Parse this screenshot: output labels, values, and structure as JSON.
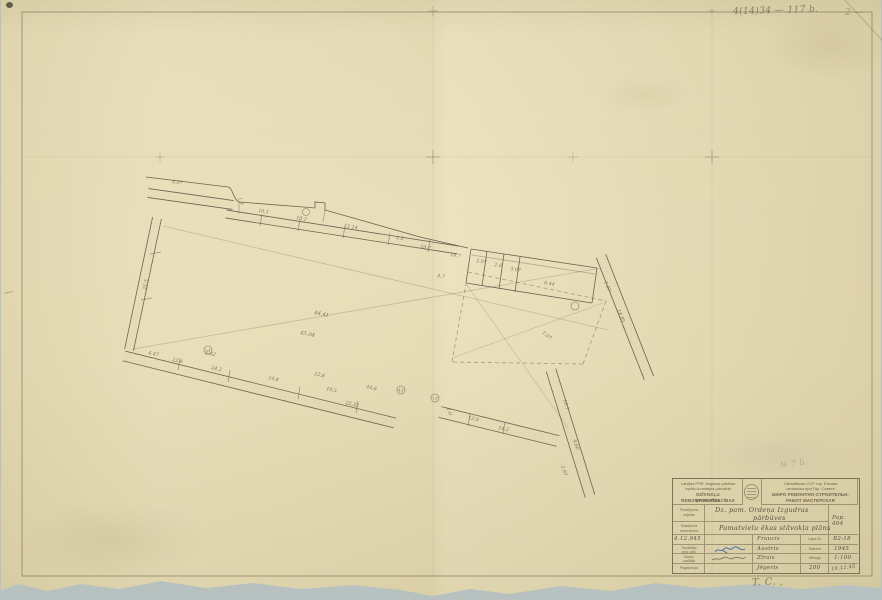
{
  "colors": {
    "paper": "#e9deb4",
    "backdrop": "#b7c2c0",
    "ink": "#6e6452",
    "pencil": "#8c8164",
    "blue_ink": "#3c57a6"
  },
  "annotations": {
    "top_right_note": "4(14)34 — 117 b.",
    "top_right_note2": "2 —",
    "above_titleblock_note": "№ 7 b.",
    "bottom_note": "T. C.  ,"
  },
  "title_block": {
    "org_left": [
      "Latvijas PSR Jelgavas pilsētas",
      "izpildu komitejas pārvalde",
      "DZĪVOKĻU REMONTCELTNIECĪBAS",
      "DARBNĪCA"
    ],
    "org_right": [
      "Латвийская ССР гор. Елгава",
      "исполком при Гор. Совете",
      "БЮРО РЕМОНТНО-СТРОИТЕЛЬН.",
      "РАБОТ МАСТЕРСКАЯ"
    ],
    "row_object": {
      "label_l1": "Pasūtījuma",
      "label_l2": "objekts",
      "value_l1": "Dz. pam. Ordeņa Izgudras",
      "value_l2": "pārbūves",
      "right_value": "Pap. 404"
    },
    "row_drawing": {
      "label_l1": "Rasējuma",
      "label_l2": "nosaukums",
      "value": "Pamatvielu ēkas stāvokļa plāns"
    },
    "sign_rows": [
      {
        "c1": "4.12.945",
        "c3": "Fraucis",
        "c4": "Lapa Nr.",
        "c5": "B2-18"
      },
      {
        "c1_l1": "Sastādīja",
        "c1_l2": "proj. vad.",
        "c3": "Austris",
        "c4": "Datums",
        "c5": "1945"
      },
      {
        "c1_l1": "Darbu",
        "c1_l2": "vadītājs",
        "c3": "Zīrais",
        "c4": "Mērogs",
        "c5": "1:100"
      },
      {
        "c1": "Pagatavoja",
        "c3": "Jēgeris",
        "c4": "200",
        "c5": "19.12.45"
      }
    ]
  },
  "drawing": {
    "bands": [
      {
        "x1": 148,
        "y1": 193,
        "x2": 233,
        "y2": 205,
        "w": 9
      },
      {
        "x1": 226,
        "y1": 214,
        "x2": 458,
        "y2": 250,
        "w": 8
      },
      {
        "x1": 157,
        "y1": 218,
        "x2": 129,
        "y2": 350,
        "w": 9
      },
      {
        "x1": 124,
        "y1": 356,
        "x2": 395,
        "y2": 423,
        "w": 10
      },
      {
        "x1": 440,
        "y1": 412,
        "x2": 558,
        "y2": 441,
        "w": 11
      },
      {
        "x1": 601,
        "y1": 256,
        "x2": 649,
        "y2": 378,
        "w": 10
      },
      {
        "x1": 551,
        "y1": 370,
        "x2": 590,
        "y2": 496,
        "w": 10
      }
    ],
    "paths": [
      {
        "d": "M146,177 L228,187 C233,188 233,199 239,202 L303,207 L315,208 L315,202 L325,203 L325,210 L420,237 L468,248"
      }
    ],
    "lines": [
      {
        "x1": 471,
        "y1": 249,
        "x2": 597,
        "y2": 268
      },
      {
        "x1": 597,
        "y1": 268,
        "x2": 592,
        "y2": 303
      },
      {
        "x1": 592,
        "y1": 303,
        "x2": 466,
        "y2": 283
      },
      {
        "x1": 466,
        "y1": 283,
        "x2": 471,
        "y2": 249
      },
      {
        "x1": 487,
        "y1": 251,
        "x2": 482,
        "y2": 286
      },
      {
        "x1": 504,
        "y1": 254,
        "x2": 499,
        "y2": 289
      },
      {
        "x1": 520,
        "y1": 257,
        "x2": 515,
        "y2": 292
      },
      {
        "x1": 472,
        "y1": 255,
        "x2": 595,
        "y2": 274,
        "o": 0.45
      },
      {
        "x1": 163,
        "y1": 226,
        "x2": 608,
        "y2": 330,
        "o": 0.3
      },
      {
        "x1": 133,
        "y1": 349,
        "x2": 601,
        "y2": 268,
        "o": 0.3
      },
      {
        "x1": 466,
        "y1": 284,
        "x2": 568,
        "y2": 428,
        "o": 0.25
      },
      {
        "x1": 452,
        "y1": 358,
        "x2": 603,
        "y2": 303,
        "o": 0.25
      },
      {
        "x1": 468,
        "y1": 272,
        "x2": 606,
        "y2": 301,
        "d": 1,
        "o": 0.55
      },
      {
        "x1": 606,
        "y1": 301,
        "x2": 583,
        "y2": 364,
        "d": 1,
        "o": 0.55
      },
      {
        "x1": 583,
        "y1": 364,
        "x2": 452,
        "y2": 362,
        "d": 1,
        "o": 0.55
      },
      {
        "x1": 452,
        "y1": 362,
        "x2": 466,
        "y2": 284,
        "d": 1,
        "o": 0.55
      },
      {
        "x1": 262,
        "y1": 214,
        "x2": 260,
        "y2": 226,
        "o": 0.6
      },
      {
        "x1": 300,
        "y1": 219,
        "x2": 298,
        "y2": 231,
        "o": 0.6
      },
      {
        "x1": 345,
        "y1": 226,
        "x2": 343,
        "y2": 238,
        "o": 0.6
      },
      {
        "x1": 390,
        "y1": 233,
        "x2": 388,
        "y2": 245,
        "o": 0.6
      },
      {
        "x1": 430,
        "y1": 240,
        "x2": 428,
        "y2": 252,
        "o": 0.6
      },
      {
        "x1": 180,
        "y1": 358,
        "x2": 178,
        "y2": 370,
        "o": 0.6
      },
      {
        "x1": 230,
        "y1": 370,
        "x2": 228,
        "y2": 382,
        "o": 0.6
      },
      {
        "x1": 300,
        "y1": 387,
        "x2": 298,
        "y2": 399,
        "o": 0.6
      },
      {
        "x1": 358,
        "y1": 401,
        "x2": 356,
        "y2": 413,
        "o": 0.6
      },
      {
        "x1": 150,
        "y1": 254,
        "x2": 161,
        "y2": 252,
        "o": 0.6
      },
      {
        "x1": 141,
        "y1": 300,
        "x2": 152,
        "y2": 298,
        "o": 0.6
      },
      {
        "x1": 470,
        "y1": 414,
        "x2": 468,
        "y2": 426,
        "o": 0.6
      },
      {
        "x1": 505,
        "y1": 422,
        "x2": 503,
        "y2": 434,
        "o": 0.6
      },
      {
        "x1": 239,
        "y1": 202,
        "x2": 239,
        "y2": 214,
        "o": 0.5
      },
      {
        "x1": 325,
        "y1": 210,
        "x2": 323,
        "y2": 222,
        "o": 0.5
      },
      {
        "x1": 433,
        "y1": 12,
        "x2": 433,
        "y2": 576,
        "o": 0.1,
        "c": "pencil"
      },
      {
        "x1": 712,
        "y1": 12,
        "x2": 712,
        "y2": 576,
        "o": 0.1,
        "c": "pencil"
      },
      {
        "x1": 22,
        "y1": 157,
        "x2": 872,
        "y2": 157,
        "o": 0.09,
        "c": "pencil"
      }
    ],
    "circles": [
      {
        "x": 208,
        "y": 350,
        "r": 4,
        "t": "2.4"
      },
      {
        "x": 401,
        "y": 390,
        "r": 4,
        "t": "4.4"
      },
      {
        "x": 435,
        "y": 398,
        "r": 4,
        "t": "1.8"
      },
      {
        "x": 575,
        "y": 306,
        "r": 4,
        "t": ""
      },
      {
        "x": 306,
        "y": 212,
        "r": 3.5,
        "t": ""
      }
    ],
    "labels": [
      {
        "x": 172,
        "y": 183,
        "r": 8,
        "t": "8.97"
      },
      {
        "x": 238,
        "y": 198,
        "r": 70,
        "t": "1.9"
      },
      {
        "x": 258,
        "y": 212,
        "r": 9,
        "t": "10.1"
      },
      {
        "x": 296,
        "y": 219,
        "r": 9,
        "t": "10.2"
      },
      {
        "x": 344,
        "y": 227,
        "r": 9,
        "t": "11.14"
      },
      {
        "x": 396,
        "y": 239,
        "r": 9,
        "t": "1.2"
      },
      {
        "x": 420,
        "y": 248,
        "r": 9,
        "t": "10.7"
      },
      {
        "x": 450,
        "y": 256,
        "r": 9,
        "t": "14.7"
      },
      {
        "x": 476,
        "y": 262,
        "r": 10,
        "t": "2.97"
      },
      {
        "x": 494,
        "y": 266,
        "r": 10,
        "t": "2.0"
      },
      {
        "x": 510,
        "y": 270,
        "r": 10,
        "t": "3.07"
      },
      {
        "x": 544,
        "y": 284,
        "r": 10,
        "t": "6.44"
      },
      {
        "x": 146,
        "y": 290,
        "r": -80,
        "t": "21.5"
      },
      {
        "x": 148,
        "y": 354,
        "r": 12,
        "t": "4.47"
      },
      {
        "x": 172,
        "y": 361,
        "r": 12,
        "t": "22.6"
      },
      {
        "x": 205,
        "y": 354,
        "r": 12,
        "t": "2.62"
      },
      {
        "x": 211,
        "y": 369,
        "r": 12,
        "t": "24.2"
      },
      {
        "x": 268,
        "y": 379,
        "r": 13,
        "t": "14.8"
      },
      {
        "x": 314,
        "y": 375,
        "r": 13,
        "t": "22.8"
      },
      {
        "x": 326,
        "y": 390,
        "r": 13,
        "t": "18.5"
      },
      {
        "x": 345,
        "y": 404,
        "r": 13,
        "t": "22.32"
      },
      {
        "x": 366,
        "y": 388,
        "r": 13,
        "t": "44.8"
      },
      {
        "x": 437,
        "y": 277,
        "r": 10,
        "t": "4.7"
      },
      {
        "x": 314,
        "y": 314,
        "r": 12,
        "t": "44.41",
        "s": 5.2
      },
      {
        "x": 300,
        "y": 334,
        "r": 12,
        "t": "45.04",
        "s": 5.2
      },
      {
        "x": 617,
        "y": 310,
        "r": 68,
        "t": "14.85"
      },
      {
        "x": 604,
        "y": 282,
        "r": 68,
        "t": "1.07"
      },
      {
        "x": 563,
        "y": 400,
        "r": 72,
        "t": "10.7"
      },
      {
        "x": 573,
        "y": 440,
        "r": 72,
        "t": "4.60"
      },
      {
        "x": 561,
        "y": 466,
        "r": 72,
        "t": "2.97"
      },
      {
        "x": 468,
        "y": 419,
        "r": 13,
        "t": "12.9"
      },
      {
        "x": 498,
        "y": 429,
        "r": 13,
        "t": "14.2"
      },
      {
        "x": 447,
        "y": 408,
        "r": 75,
        "t": "2.0"
      },
      {
        "x": 542,
        "y": 333,
        "r": 40,
        "t": "2.07"
      }
    ],
    "crosses": [
      {
        "x": 433,
        "y": 157,
        "s": 7,
        "o": 0.55
      },
      {
        "x": 712,
        "y": 157,
        "s": 7,
        "o": 0.55
      },
      {
        "x": 160,
        "y": 157,
        "s": 5,
        "o": 0.35
      },
      {
        "x": 573,
        "y": 157,
        "s": 5,
        "o": 0.3
      },
      {
        "x": 433,
        "y": 11,
        "s": 5,
        "o": 0.4
      },
      {
        "x": 712,
        "y": 11,
        "s": 4,
        "o": 0.3
      }
    ]
  }
}
